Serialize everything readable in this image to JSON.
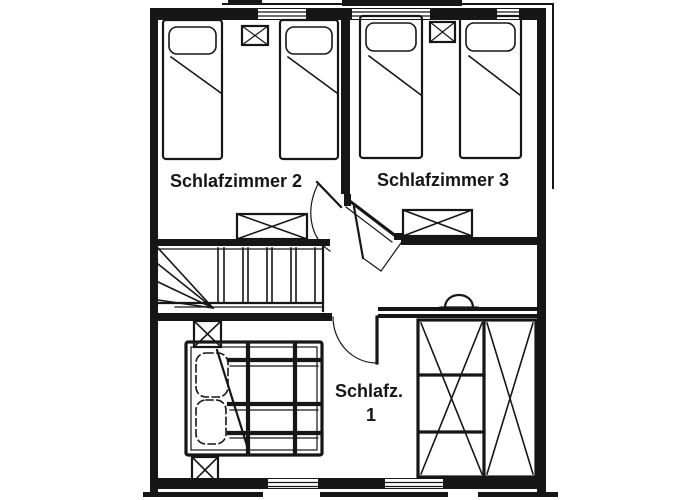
{
  "colors": {
    "ink": "#161616",
    "paper": "#ffffff"
  },
  "plan": {
    "type": "floor-plan",
    "rooms": [
      {
        "id": "schlafzimmer-2",
        "label": "Schlafzimmer 2"
      },
      {
        "id": "schlafzimmer-3",
        "label": "Schlafzimmer 3"
      },
      {
        "id": "schlafzimmer-1",
        "label": "Schlafz.",
        "number": "1"
      }
    ],
    "symbols": [
      "single-bed",
      "pillow",
      "crossed-box",
      "double-bed",
      "wardrobe-crossed",
      "staircase-winder",
      "door-swing",
      "window",
      "semicircle-fixture"
    ]
  }
}
